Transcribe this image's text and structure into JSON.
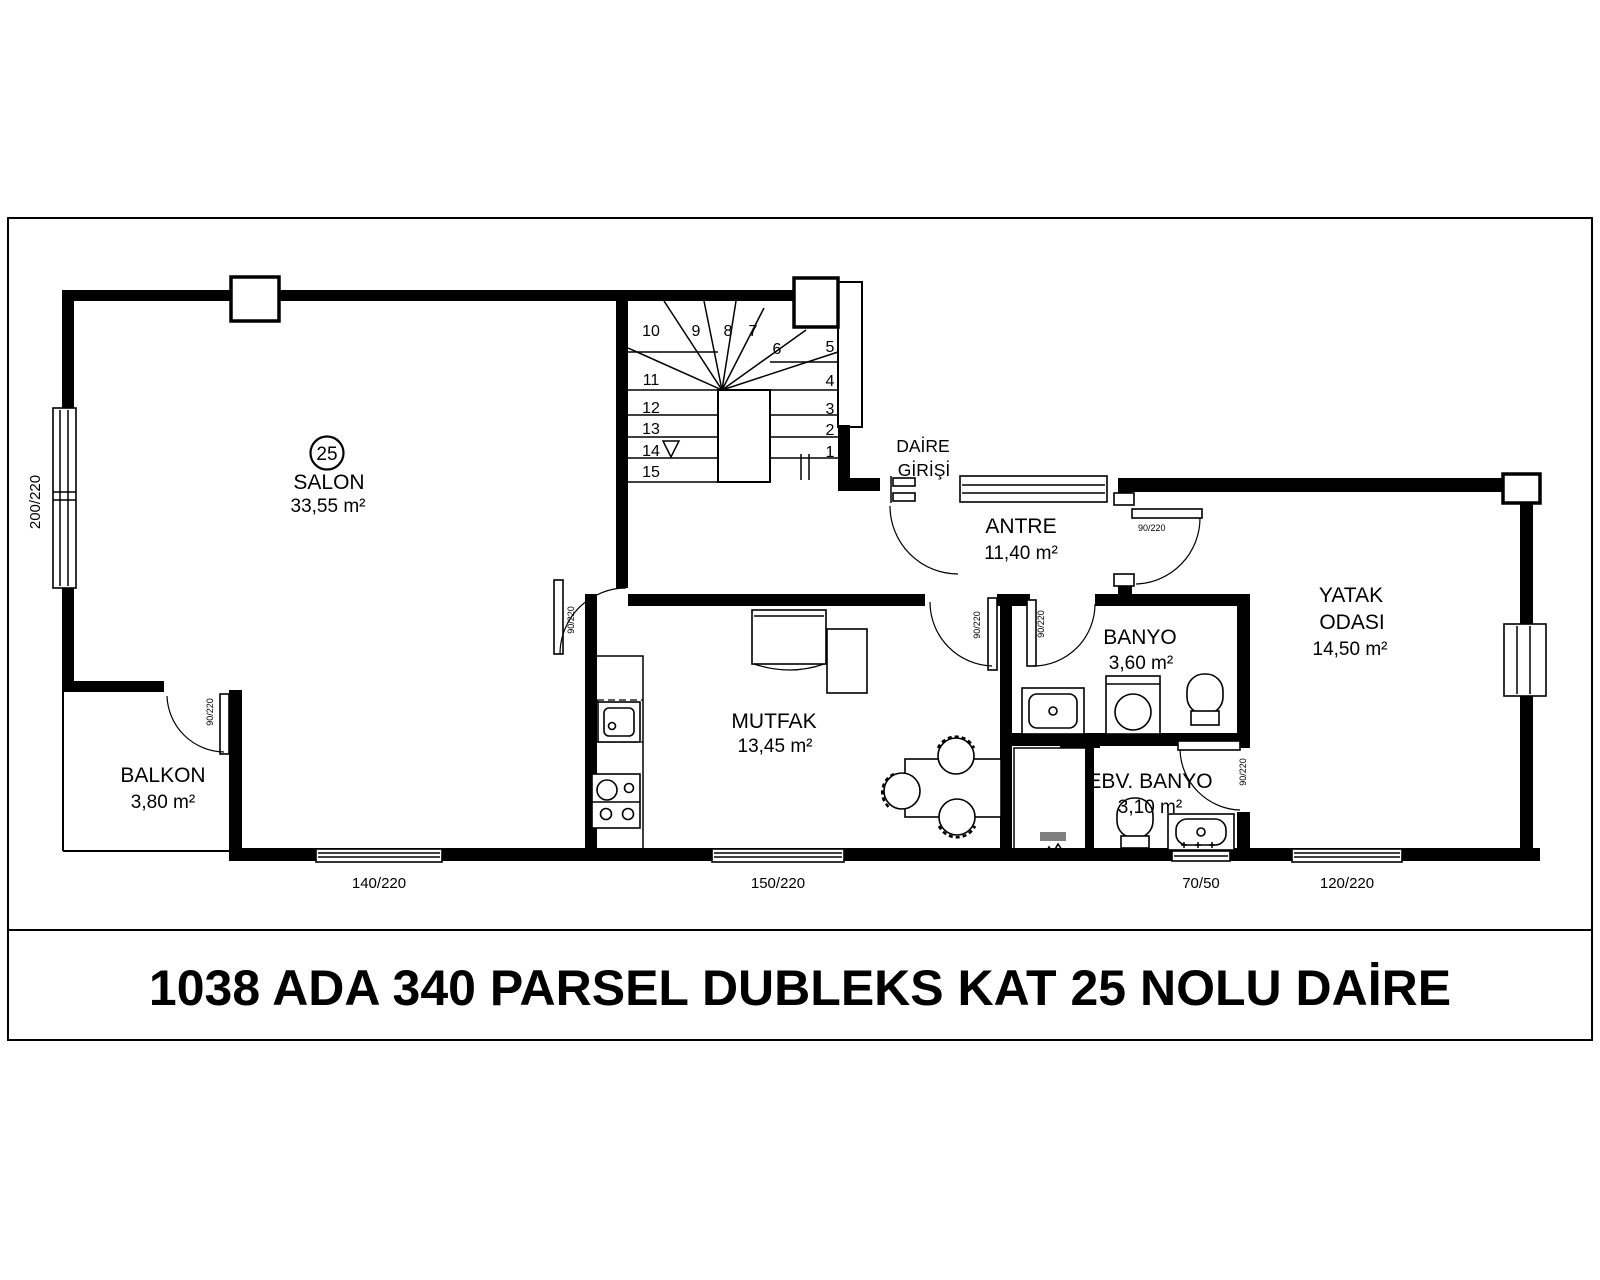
{
  "title": "1038 ADA 340 PARSEL  DUBLEKS KAT 25 NOLU DAİRE",
  "unit_number": "25",
  "rooms": {
    "salon": {
      "name": "SALON",
      "area": "33,55 m²"
    },
    "antre": {
      "name": "ANTRE",
      "area": "11,40 m²"
    },
    "mutfak": {
      "name": "MUTFAK",
      "area": "13,45 m²"
    },
    "banyo": {
      "name": "BANYO",
      "area": "3,60 m²"
    },
    "ebv_banyo": {
      "name": "EBV. BANYO",
      "area": "3,10 m²"
    },
    "yatak_odasi": {
      "name_line1": "YATAK",
      "name_line2": "ODASI",
      "area": "14,50 m²"
    },
    "balkon": {
      "name": "BALKON",
      "area": "3,80 m²"
    }
  },
  "entrance": {
    "label_line1": "DAİRE",
    "label_line2": "GİRİŞİ"
  },
  "stairs": {
    "steps": [
      "1",
      "2",
      "3",
      "4",
      "5",
      "6",
      "7",
      "8",
      "9",
      "10",
      "11",
      "12",
      "13",
      "14",
      "15"
    ]
  },
  "dimensions": {
    "left_window": "200/220",
    "bottom_windows": [
      "140/220",
      "150/220",
      "70/50",
      "120/220"
    ],
    "door": "90/220"
  }
}
